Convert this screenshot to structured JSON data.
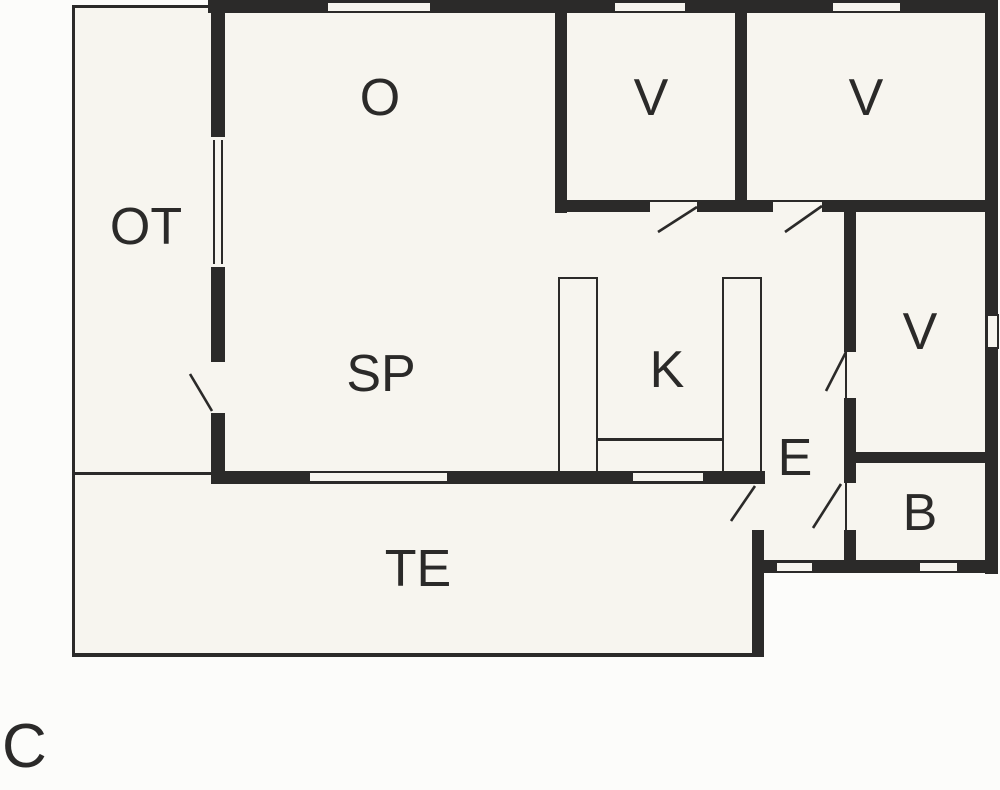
{
  "plan": {
    "variant_label": "C",
    "rooms": [
      {
        "key": "o",
        "label": "O"
      },
      {
        "key": "v1",
        "label": "V"
      },
      {
        "key": "v2",
        "label": "V"
      },
      {
        "key": "ot",
        "label": "OT"
      },
      {
        "key": "sp",
        "label": "SP"
      },
      {
        "key": "k",
        "label": "K"
      },
      {
        "key": "v3",
        "label": "V"
      },
      {
        "key": "e",
        "label": "E"
      },
      {
        "key": "b",
        "label": "B"
      },
      {
        "key": "te",
        "label": "TE"
      }
    ],
    "colors": {
      "wall": "#2b2a29",
      "floor": "#f7f5ef",
      "outside": "#fcfcfa"
    }
  }
}
